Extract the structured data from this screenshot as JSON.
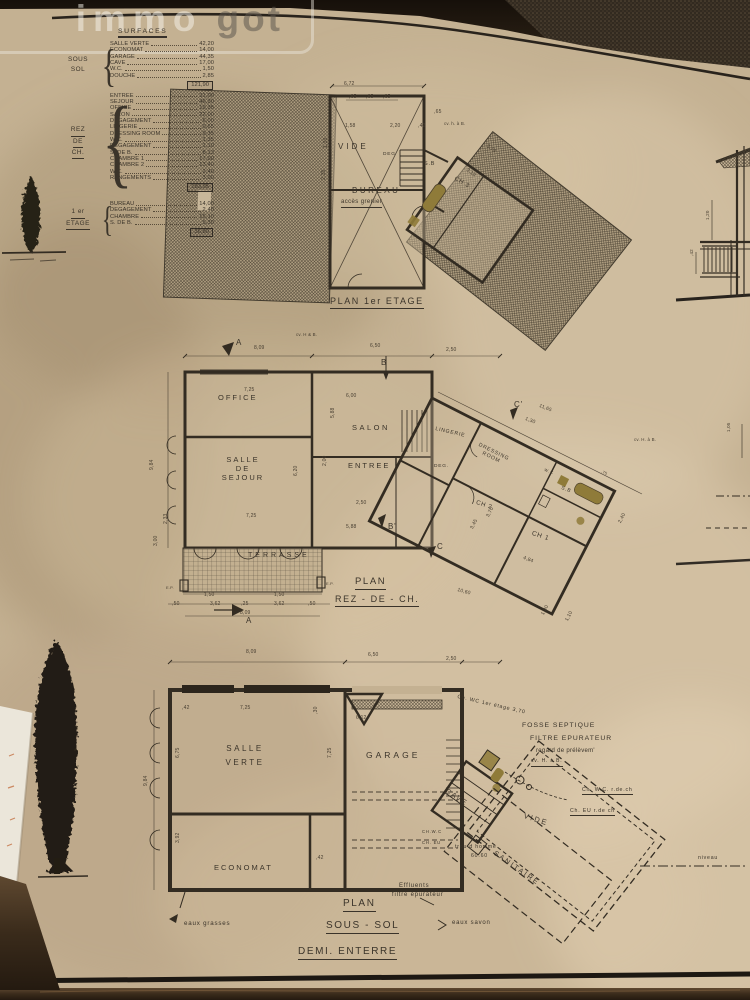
{
  "watermark": {
    "immo": "immo",
    "got": "got"
  },
  "surfaces": {
    "title": "SURFACES",
    "groups": [
      {
        "floor": [
          "SOUS",
          "SOL"
        ],
        "rows": [
          [
            "SALLE VERTE",
            "42,20"
          ],
          [
            "ECONOMAT",
            "14,00"
          ],
          [
            "GARAGE",
            "44,35"
          ],
          [
            "CAVE",
            "17,00"
          ],
          [
            "W.C.",
            "1,50"
          ],
          [
            "DOUCHE",
            "2,85"
          ]
        ],
        "total": "121,90"
      },
      {
        "floor": [
          "REZ",
          "DE",
          "CH."
        ],
        "rows": [
          [
            "ENTREE",
            "31,00"
          ],
          [
            "SEJOUR",
            "46,30"
          ],
          [
            "OFFICE",
            "19,35"
          ],
          [
            "SALON",
            "22,00"
          ],
          [
            "DEGAGEMENT",
            "6,00"
          ],
          [
            "LINGERIE",
            "0,65"
          ],
          [
            "DRESSING ROOM",
            "9,35"
          ],
          [
            "W.C.",
            "1,35"
          ],
          [
            "DEGAGEMENT",
            "1,10"
          ],
          [
            "S. DE B.",
            "8,13"
          ],
          [
            "CHAMBRE 1",
            "17,00"
          ],
          [
            "CHAMBRE 2",
            "13,40"
          ],
          [
            "W.C.",
            "2,40"
          ],
          [
            "RANGEMENTS",
            "3,00"
          ]
        ],
        "total": "183,95"
      },
      {
        "floor": [
          "1 er",
          "ETAGE"
        ],
        "rows": [
          [
            "BUREAU",
            "14,00"
          ],
          [
            "DEGAGEMENT",
            "2,40"
          ],
          [
            "CHAMBRE",
            "15,10"
          ],
          [
            "S. DE B.",
            "5,30"
          ]
        ],
        "total": "36,80"
      }
    ]
  },
  "plan_etage": {
    "title": "PLAN 1er ETAGE",
    "rooms": {
      "vide": "VIDE",
      "deg": "DEG",
      "bureau": "BUREAU",
      "acces": "accès grenier",
      "sb": "S.B",
      "ch3": "CH 3"
    },
    "dims": [
      "6,72",
      ",65",
      ",65",
      ",65",
      "1,58",
      "2,20",
      ",42",
      "3,10",
      "3,79",
      "1,33",
      "2,35",
      "cv. h. à B.",
      ",65"
    ]
  },
  "plan_rdc": {
    "title1": "PLAN",
    "title2": "REZ - DE - CH.",
    "rooms": {
      "office": "OFFICE",
      "sejour": "SALLE\nDE\nSEJOUR",
      "salon": "SALON",
      "entree": "ENTREE",
      "terrasse": "TERRASSE",
      "lingerie": "LINGERIE",
      "deg": "DEG.",
      "dressing": "DRESSING\nROOM",
      "ch2": "CH 2",
      "ch1": "CH 1",
      "sb": "S.B",
      "wc": "W.C"
    },
    "markers": {
      "a1": "A",
      "b": "B",
      "bp": "B'",
      "cp": "C'",
      "c": "C",
      "a2": "A",
      "ep1": "E.P.",
      "ep2": "E.P."
    },
    "dims": [
      "8,09",
      "6,50",
      "2,50",
      "cv. H & B.",
      "7,25",
      "6,00",
      "5,88",
      "9,84",
      "3,00",
      "2,33",
      "6,20",
      "2,00",
      "2,50",
      "5,88",
      "7,25",
      "1,50",
      "1,50",
      ",50",
      "3,62",
      ",25",
      "3,62",
      ",50",
      "8,09",
      "11,65",
      "1,30",
      "3,70",
      "3,45",
      "2,40",
      "4,84",
      "10,60",
      "1,30",
      "1,10",
      "cv. H. à B.",
      ",75"
    ]
  },
  "plan_soussol": {
    "title1": "PLAN",
    "title2": "SOUS - SOL",
    "title3": "DEMI. ENTERRE",
    "rooms": {
      "salle": "SALLE\nVERTE",
      "economat": "ECONOMAT",
      "garage": "GARAGE",
      "cave": "CAVE",
      "vide": "VIDE",
      "sanitaire": "SANITAIRE"
    },
    "ann": {
      "fosse1": "FOSSE SEPTIQUE",
      "fosse2": "FILTRE EPURATEUR",
      "fosse3": "regard de prélèvem'",
      "cvhb": "cv. H. à B.",
      "chwc_et": "Ch. WC 1er étage 3,70",
      "chwc_rdc": "Ch. W.C. r.de.ch",
      "cheu_rdc": "Ch. EU r.de ch",
      "trou": "trou d homme",
      "s60": "60.60",
      "esavon": "eaux savon",
      "eff1": "Effluents",
      "eff2": "filtre épurateur",
      "egrasses": "eaux grasses",
      "chwc_s": "CH.W.C",
      "cheu_s": "CH. EU",
      "niveau": "niveau"
    },
    "dims": [
      "8,09",
      "6,50",
      "2,50",
      ",42",
      "7,25",
      ",30",
      "6,12",
      "7,25",
      "6,75",
      "3,92",
      "9,84",
      ",42"
    ]
  },
  "elevation": {
    "dims": [
      ",42",
      "1,20",
      "1,05"
    ]
  }
}
